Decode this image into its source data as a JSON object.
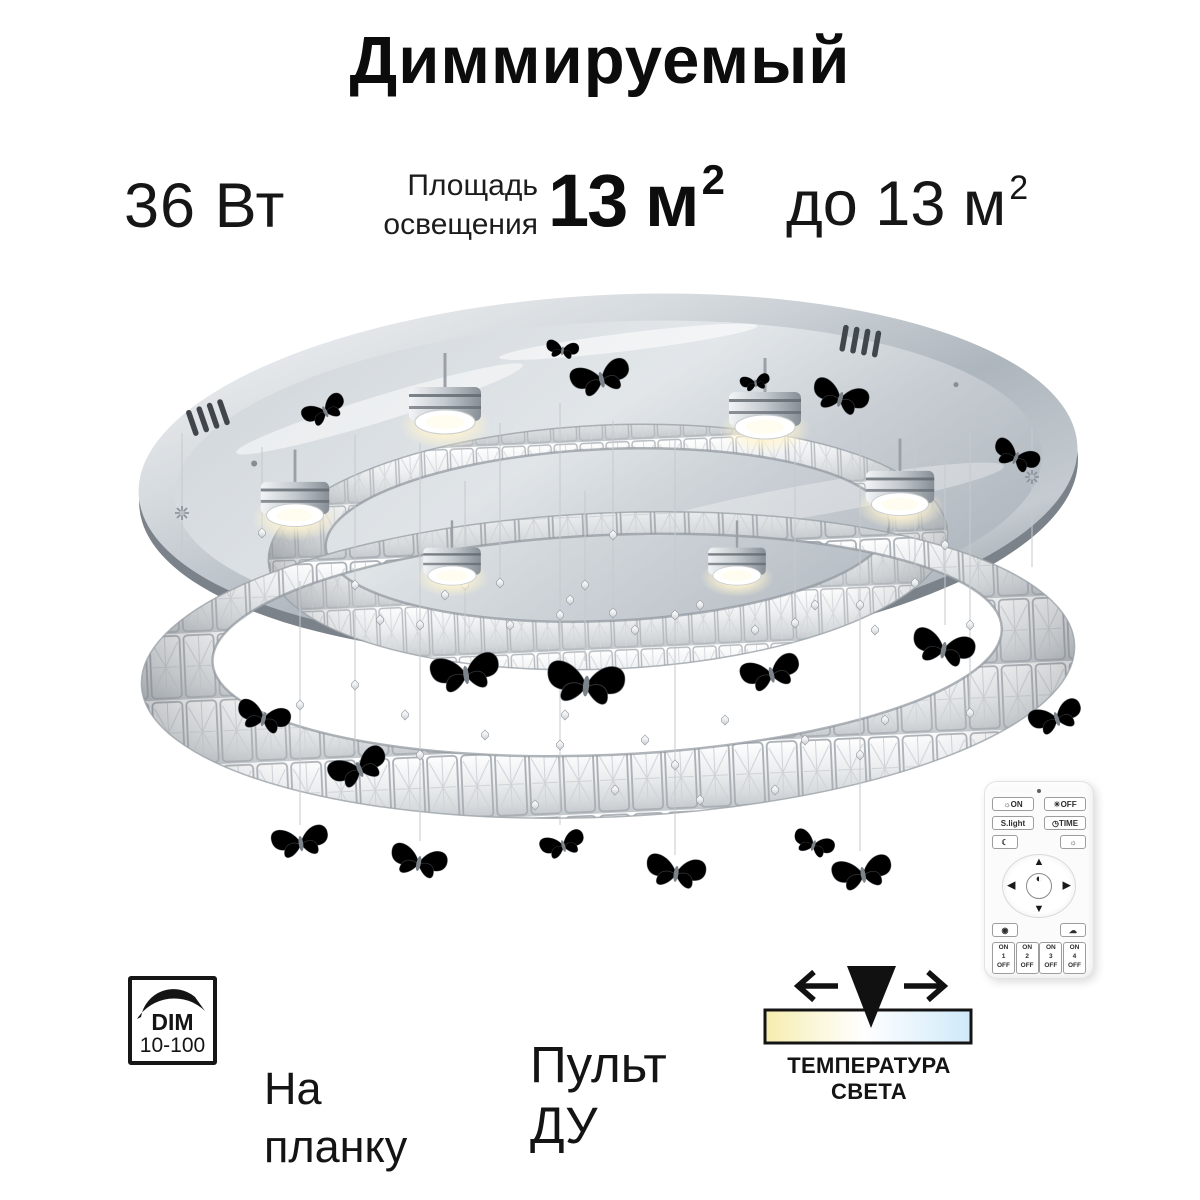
{
  "title": "Диммируемый",
  "specs": {
    "wattage": "36 Вт",
    "area_label_line1": "Площадь",
    "area_label_line2": "освещения",
    "area_value": "13 м",
    "area_value_sup": "2",
    "upto_value": "до 13 м",
    "upto_sup": "2"
  },
  "badges": {
    "dim_label": "DIM",
    "dim_range": "10-100",
    "mount_line1": "На",
    "mount_line2": "планку",
    "remote_line1": "Пульт",
    "remote_line2": "ДУ",
    "temperature_label": "ТЕМПЕРАТУРА СВЕТА"
  },
  "temperature_bar": {
    "warm_color": "#f6ecae",
    "neutral_color": "#ffffff",
    "cool_color": "#cfe9fa"
  },
  "remote": {
    "on_icon": "☼",
    "on_label": "ON",
    "off_icon": "☀",
    "off_label": "OFF",
    "slight_label": "S.light",
    "time_icon": "◷",
    "time_label": "TIME",
    "moon_icon": "☾",
    "bright_icon": "☼",
    "up_icon": "▲",
    "down_icon": "▼",
    "left_icon": "◀",
    "right_icon": "▶",
    "center_icon": "◐",
    "rgb_icon": "◉",
    "cloud_icon": "☁",
    "channels": [
      {
        "on": "ON",
        "num": "1",
        "off": "OFF"
      },
      {
        "on": "ON",
        "num": "2",
        "off": "OFF"
      },
      {
        "on": "ON",
        "num": "3",
        "off": "OFF"
      },
      {
        "on": "ON",
        "num": "4",
        "off": "OFF"
      }
    ]
  },
  "colors": {
    "text": "#111111",
    "chrome_light": "#eef1f3",
    "chrome_dark": "#9aa2aa",
    "accent_black": "#141414"
  }
}
